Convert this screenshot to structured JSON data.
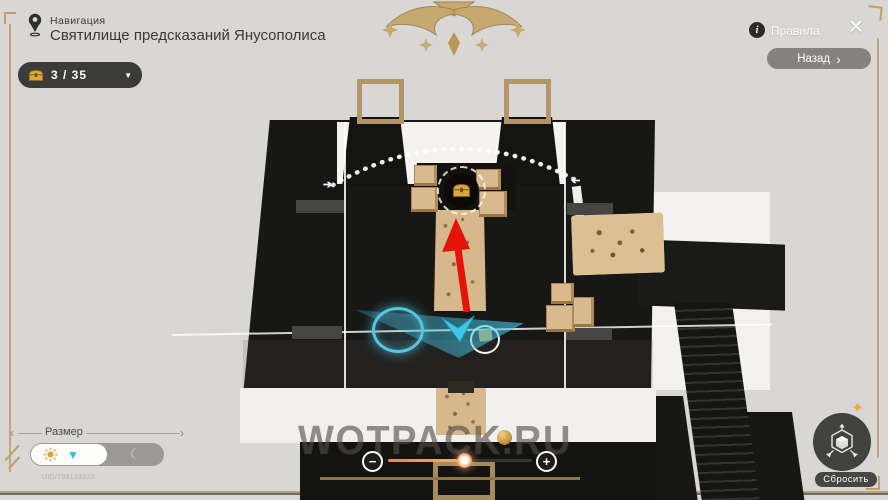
{
  "header": {
    "section_label": "Навигация",
    "location_title": "Святилище предсказаний Янусополиса"
  },
  "chest_counter": {
    "value": "3 / 35",
    "dropdown_glyph": "▼"
  },
  "top_right": {
    "info_glyph": "i",
    "rules_label": "Правила",
    "close_glyph": "✕",
    "back_label": "Назад",
    "back_chevron": "›"
  },
  "bottom_left": {
    "size_label": "Размер",
    "slider_left_glyph": "‹",
    "slider_right_glyph": "›",
    "uid": "UID/798133223"
  },
  "zoom_control": {
    "minus_glyph": "−",
    "plus_glyph": "+"
  },
  "reset_control": {
    "label": "Сбросить"
  },
  "watermark": "WOTPACK.RU",
  "map": {
    "arc_arrow_glyph": "➔"
  },
  "colors": {
    "background": "#d8d7d5",
    "map_black": "#171716",
    "accent_gold": "#bfa06a",
    "chest_gold": "#d9a93c",
    "crate_tan": "#d9ba8c",
    "arrow_red": "#e41408",
    "marker_cyan": "#41c6e6",
    "pill_dark": "#3b3b3a"
  }
}
